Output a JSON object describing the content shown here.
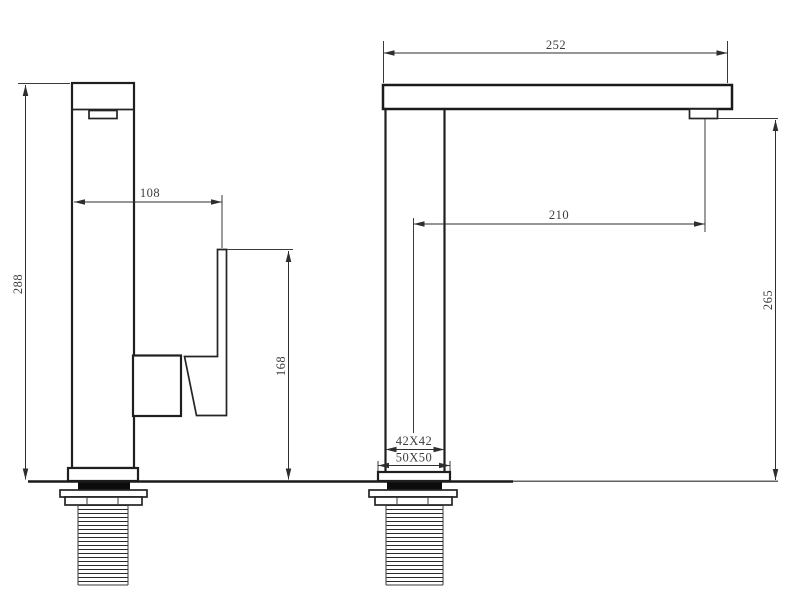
{
  "drawing": {
    "type": "technical-dimension-drawing",
    "subject": "kitchen-faucet-two-views",
    "colors": {
      "background": "#ffffff",
      "object_line": "#1f1f1f",
      "dimension_line": "#3a3a3a",
      "dimension_text": "#3d3d3d",
      "gasket_fill": "#0c0c0c"
    }
  },
  "labels": {
    "side_overall_height": "288",
    "side_handle_offset": "108",
    "side_handle_height": "168",
    "front_spout_overall": "252",
    "front_outlet_reach": "210",
    "front_outlet_height": "265",
    "front_body_section": "42X42",
    "front_base_section": "50X50"
  }
}
